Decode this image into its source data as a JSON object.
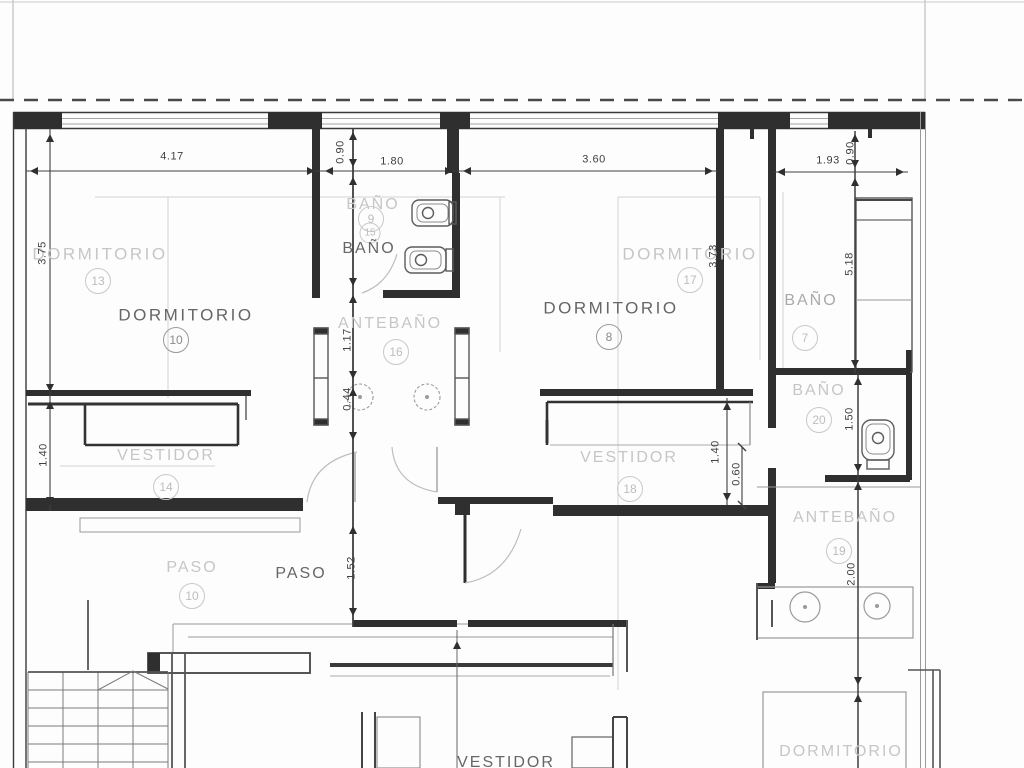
{
  "plan": {
    "rooms": [
      {
        "id": "dormitorio-13",
        "label": "DORMITORIO",
        "number": "13",
        "tone": "faint"
      },
      {
        "id": "dormitorio-10",
        "label": "DORMITORIO",
        "number": "10",
        "tone": "dark"
      },
      {
        "id": "bano-9",
        "label": "BAÑO",
        "number": "9",
        "tone": "faint"
      },
      {
        "id": "bano-15",
        "label": "",
        "number": "15",
        "tone": "faint"
      },
      {
        "id": "bano-central",
        "label": "BAÑO",
        "number": "",
        "tone": "dark"
      },
      {
        "id": "antebano-16",
        "label": "ANTEBAÑO",
        "number": "16",
        "tone": "faint"
      },
      {
        "id": "dormitorio-17",
        "label": "DORMITORIO",
        "number": "17",
        "tone": "faint"
      },
      {
        "id": "dormitorio-8",
        "label": "DORMITORIO",
        "number": "8",
        "tone": "dark"
      },
      {
        "id": "bano-7",
        "label": "BAÑO",
        "number": "7",
        "tone": "medium"
      },
      {
        "id": "bano-20",
        "label": "BAÑO",
        "number": "20",
        "tone": "faint"
      },
      {
        "id": "antebano-19",
        "label": "ANTEBAÑO",
        "number": "19",
        "tone": "faint"
      },
      {
        "id": "vestidor-14",
        "label": "VESTIDOR",
        "number": "14",
        "tone": "faint"
      },
      {
        "id": "vestidor-18",
        "label": "VESTIDOR",
        "number": "18",
        "tone": "faint"
      },
      {
        "id": "paso-10",
        "label": "PASO",
        "number": "10",
        "tone": "faint"
      },
      {
        "id": "paso",
        "label": "PASO",
        "number": "",
        "tone": "dark"
      },
      {
        "id": "vestidor-bottom",
        "label": "VESTIDOR",
        "number": "",
        "tone": "dark"
      },
      {
        "id": "dormitorio-bottom",
        "label": "DORMITORIO",
        "number": "",
        "tone": "faint"
      }
    ],
    "dims": [
      {
        "id": "dim-4-17",
        "value": "4.17"
      },
      {
        "id": "dim-0-90-bath",
        "value": "0.90"
      },
      {
        "id": "dim-1-80",
        "value": "1.80"
      },
      {
        "id": "dim-3-60",
        "value": "3.60"
      },
      {
        "id": "dim-1-93",
        "value": "1.93"
      },
      {
        "id": "dim-0-90-right",
        "value": "0.90"
      },
      {
        "id": "dim-3-75",
        "value": "3.75"
      },
      {
        "id": "dim-5-18",
        "value": "5.18"
      },
      {
        "id": "dim-3-73",
        "value": "3.73"
      },
      {
        "id": "dim-1-17",
        "value": "1.17"
      },
      {
        "id": "dim-0-44",
        "value": "0.44"
      },
      {
        "id": "dim-1-40-left",
        "value": "1.40"
      },
      {
        "id": "dim-1-40-right",
        "value": "1.40"
      },
      {
        "id": "dim-0-60",
        "value": "0.60"
      },
      {
        "id": "dim-1-50",
        "value": "1.50"
      },
      {
        "id": "dim-2-00",
        "value": "2.00"
      },
      {
        "id": "dim-1-52",
        "value": "1.52"
      }
    ],
    "colors": {
      "wall": "#2f2f2f",
      "faint": "#d2d2d2",
      "dim_line": "#3f3f3f"
    }
  }
}
